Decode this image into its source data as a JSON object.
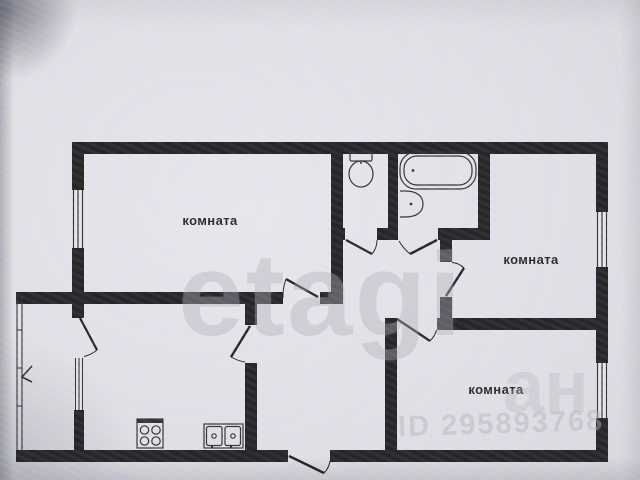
{
  "document": {
    "kind": "apartment floor plan photo"
  },
  "rooms": [
    {
      "id": "room-top-left",
      "label": "комната"
    },
    {
      "id": "room-middle-right",
      "label": "комната"
    },
    {
      "id": "room-bottom-right",
      "label": "комната"
    }
  ],
  "fixtures": {
    "toilet": "toilet-icon",
    "bathtub": "bathtub-icon",
    "wash_basin": "washbasin-icon",
    "stove": "stove-icon",
    "kitchen_sink": "kitchen-sink-icon"
  },
  "watermarks": {
    "brand": "etagi",
    "fragment": "ан",
    "listing_id": "ID 295893768"
  },
  "colors": {
    "wall": "#1c1c1f",
    "line": "#2b2b2e",
    "paper": "#eceaf0",
    "background": "#e4e3e9",
    "label-text": "#212124",
    "watermark": "#b2b0bb"
  }
}
